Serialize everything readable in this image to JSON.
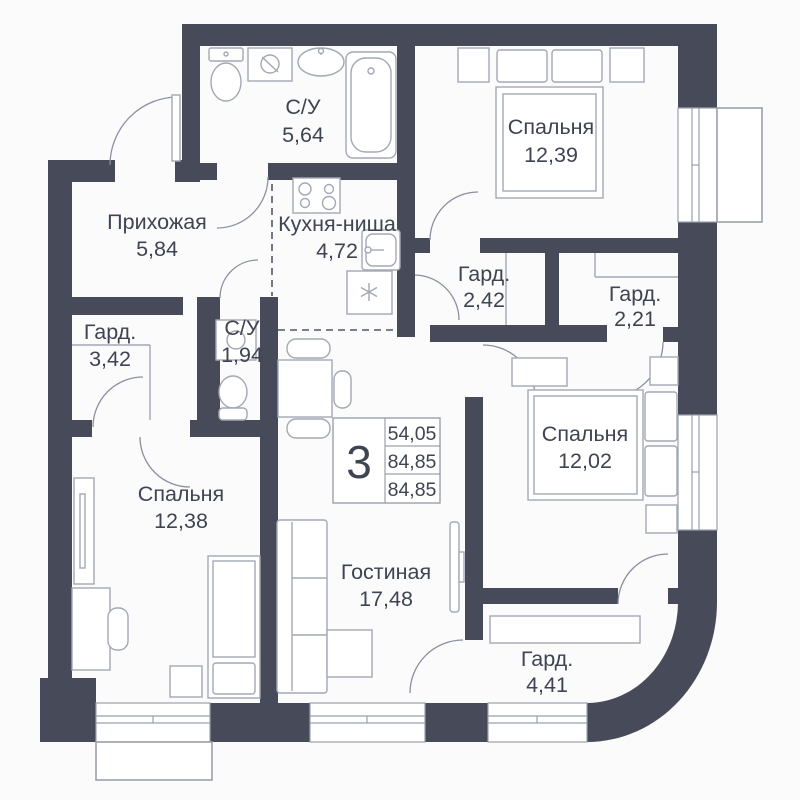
{
  "plan": {
    "type": "floor-plan-apartment",
    "rooms": [
      {
        "id": "bathroom-main",
        "name": "С/У",
        "area": "5,64"
      },
      {
        "id": "bedroom-top",
        "name": "Спальня",
        "area": "12,39"
      },
      {
        "id": "hallway",
        "name": "Прихожая",
        "area": "5,84"
      },
      {
        "id": "kitchen-niche",
        "name": "Кухня-ниша",
        "area": "4,72"
      },
      {
        "id": "wardrobe-1",
        "name": "Гард.",
        "area": "2,42"
      },
      {
        "id": "wardrobe-2",
        "name": "Гард.",
        "area": "2,21"
      },
      {
        "id": "wardrobe-3",
        "name": "Гард.",
        "area": "3,42"
      },
      {
        "id": "bathroom-small",
        "name": "С/У",
        "area": "1,94"
      },
      {
        "id": "bedroom-right",
        "name": "Спальня",
        "area": "12,02"
      },
      {
        "id": "bedroom-left",
        "name": "Спальня",
        "area": "12,38"
      },
      {
        "id": "living-room",
        "name": "Гостиная",
        "area": "17,48"
      },
      {
        "id": "wardrobe-4",
        "name": "Гард.",
        "area": "4,41"
      }
    ],
    "legend": {
      "rooms_count": "3",
      "areas": [
        "54,05",
        "84,85",
        "84,85"
      ]
    },
    "colors": {
      "wall": "#474b59",
      "background": "#fbfbfc",
      "furniture_stroke": "#a3a8b4",
      "text": "#3f4452"
    }
  }
}
